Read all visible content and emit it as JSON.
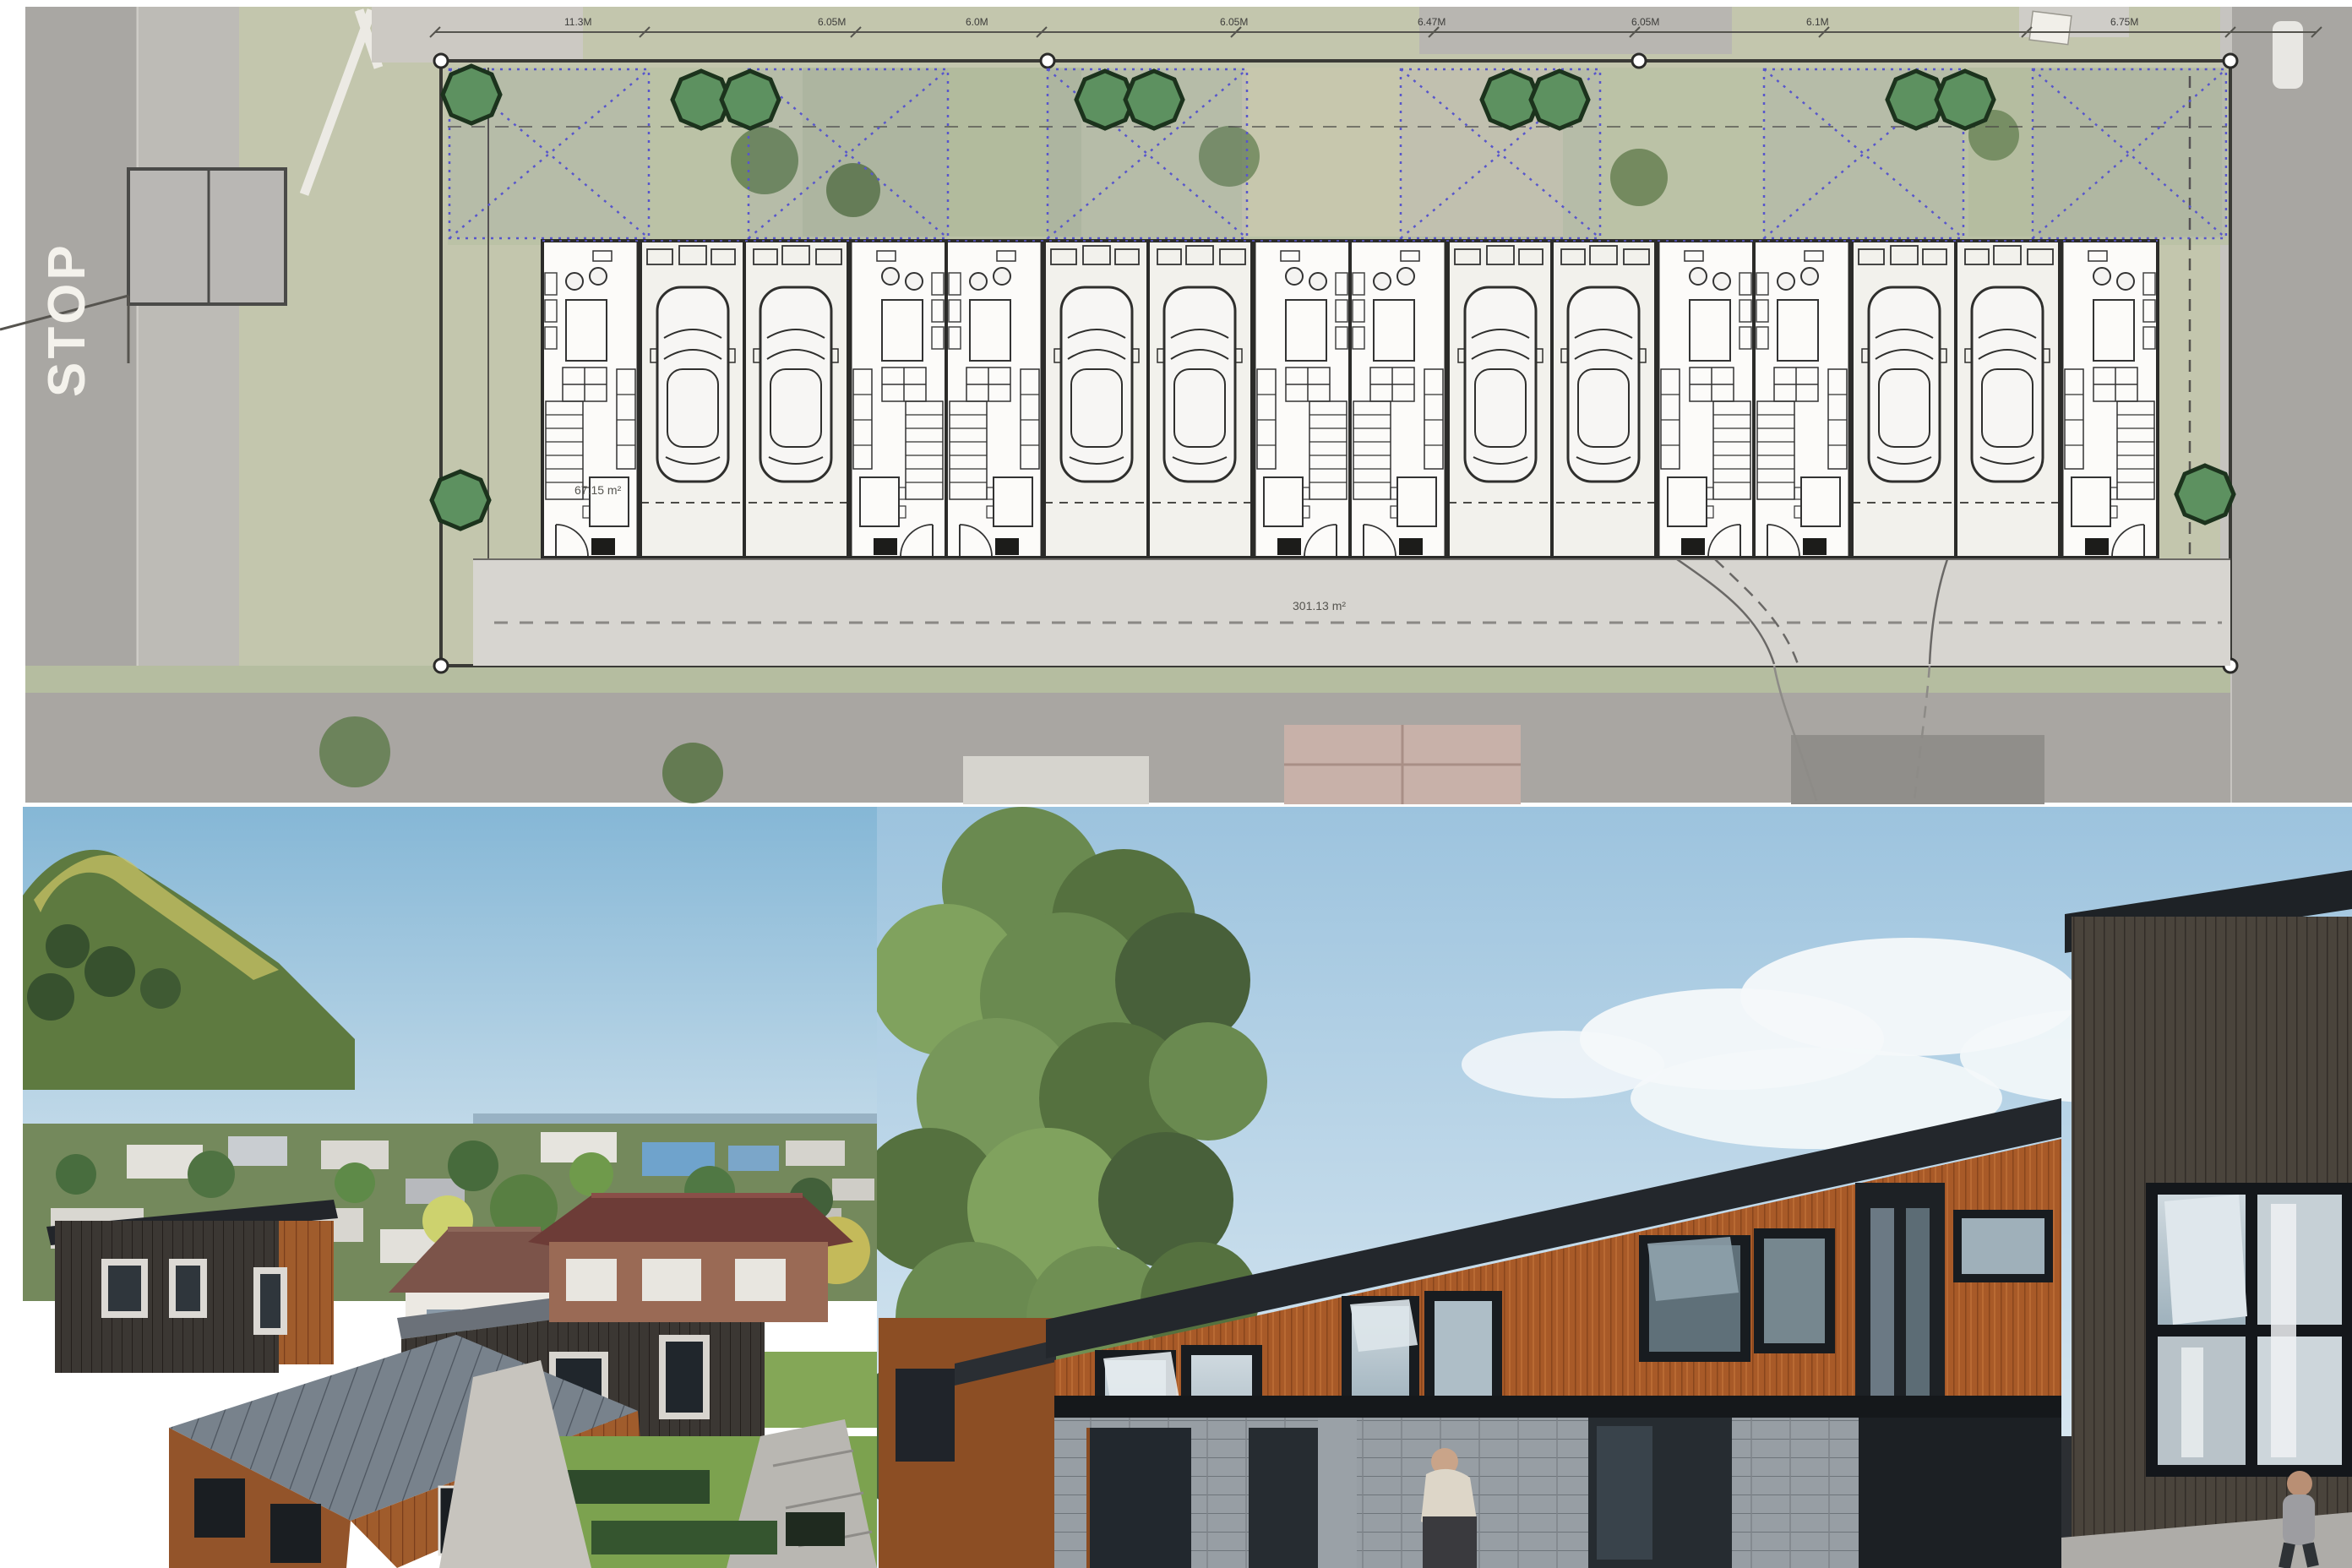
{
  "site_plan": {
    "road_marking": "STOP",
    "unit_area_label": "67.15 m²",
    "driveway_area_label": "301.13 m²",
    "dimension_labels": [
      "11.3M",
      "6.05M",
      "6.0M",
      "6.05M",
      "6.47M",
      "6.05M",
      "6.1M",
      "6.75M"
    ],
    "units_count": "8",
    "colors": {
      "boundary_line": "#3a3a36",
      "overlay_blue": "#5856cc",
      "tree_fill": "#5d9160",
      "tree_stroke": "#1c331d",
      "plan_paper": "#fcfbf9",
      "driveway_gray": "#d7d5d0",
      "aerial_road": "#a9a7a3",
      "aerial_lawn": "#c3c6ad",
      "patio_tan": "#e3ba9f"
    }
  },
  "photo_left": {
    "type": "aerial-suburb-render",
    "colors": {
      "sky": "#85b7d6",
      "hill_green": "#5e7a40",
      "hill_sunlit": "#c9c364",
      "roof_blue": "#6fa3cc",
      "roof_brown": "#7c544a",
      "shed_green": "#3f7c5e",
      "timber_wall": "#a65d2b",
      "dark_cladding": "#3a3631",
      "seam_roof": "#78828c",
      "brick_roof": "#6d3c37",
      "grass": "#7ca24f"
    }
  },
  "photo_right": {
    "type": "townhouse-street-render",
    "colors": {
      "sky": "#9cc3de",
      "cloud": "#f4f8fa",
      "tree_green": "#6a8a50",
      "cedar_wall": "#a85a28",
      "fascia_dark": "#23272c",
      "window_frame": "#181c20",
      "glass": "#cfd9df",
      "block_wall": "#979ea4",
      "dark_building": "#4a443c"
    }
  }
}
